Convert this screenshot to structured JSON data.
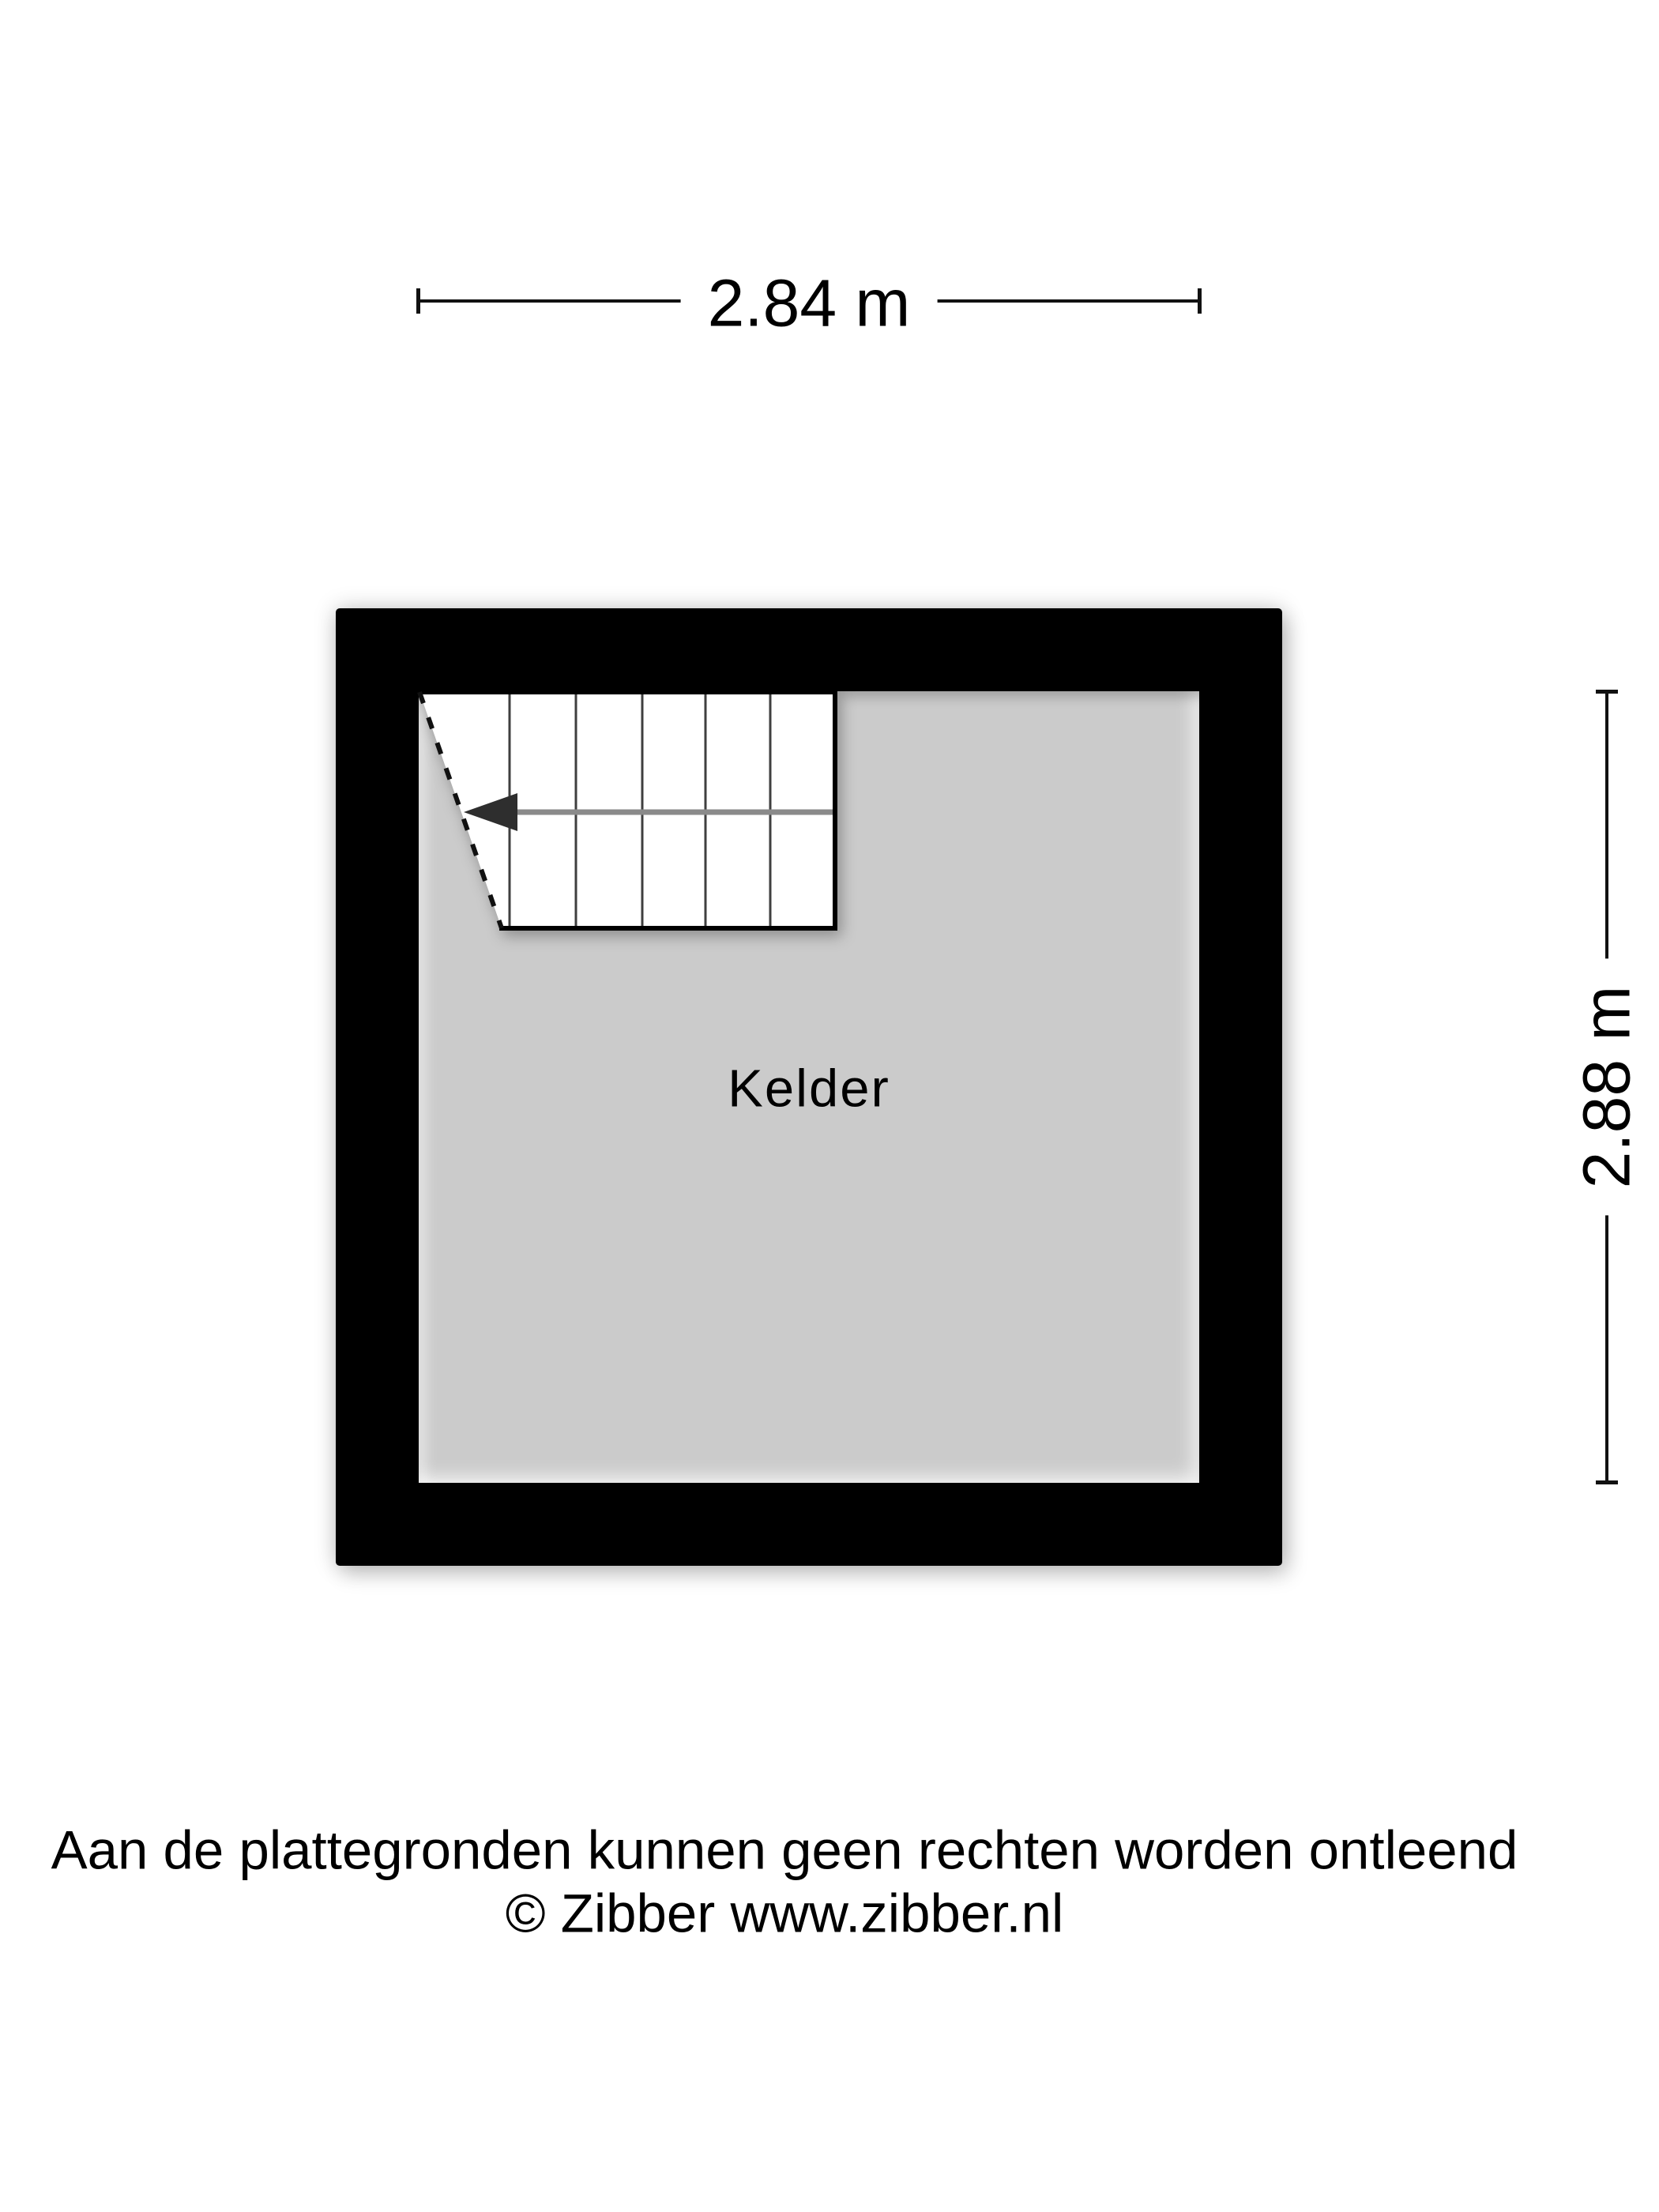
{
  "plan": {
    "room": {
      "label": "Kelder"
    },
    "dimensions": {
      "width": {
        "label": "2.84 m"
      },
      "height": {
        "label": "2.88 m"
      }
    },
    "stairs": {
      "steps": 6,
      "walk_direction": "left"
    }
  },
  "footer": {
    "disclaimer": "Aan de plattegronden kunnen geen rechten worden ontleend",
    "copyright": "© Zibber www.zibber.nl"
  },
  "colors": {
    "wall": "#000000",
    "floor": "#cbcbcb",
    "stairs_fill": "#ffffff",
    "step_line": "#3f3f3f",
    "walk_line": "#8a8a8a",
    "arrow": "#2e2e2e",
    "line": "#111111",
    "text": "#000000"
  }
}
